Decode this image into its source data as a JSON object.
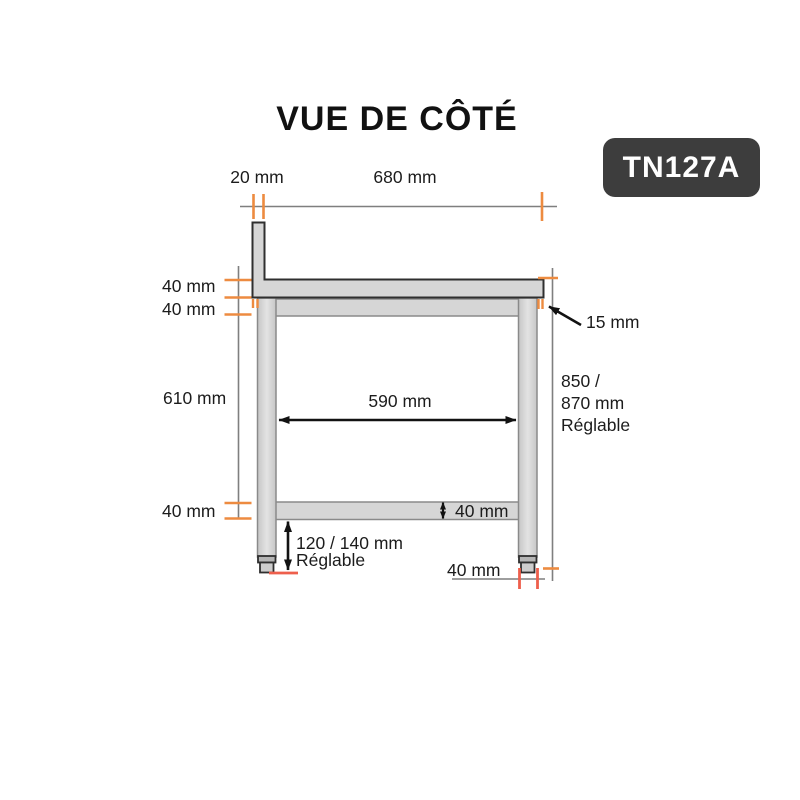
{
  "title": "VUE DE CÔTÉ",
  "product_code": "TN127A",
  "colors": {
    "accent_orange": "#ED8B40",
    "accent_red": "#EE5F4C",
    "dim_line_gray": "#7F7F7F",
    "steel_fill": "#D6D6D6",
    "steel_outline_dark": "#2F2F2F",
    "steel_outline_gray": "#8A8A8A",
    "badge_bg": "#3D3D3D",
    "label_text": "#1C1C1C"
  },
  "dimensions": {
    "upstand_width": "20 mm",
    "top_length": "680 mm",
    "top_thickness": "40 mm",
    "frame_rail_height": "40 mm",
    "leg_clearance_height": "610 mm",
    "shelf_thickness_left": "40 mm",
    "inner_width": "590 mm",
    "top_overhang": "15 mm",
    "height_line1": "850 /",
    "height_line2": "870 mm",
    "height_line3": "Réglable",
    "shelf_thickness": "40 mm",
    "foot_height_line1": "120 / 140 mm",
    "foot_height_line2": "Réglable",
    "leg_width": "40 mm"
  }
}
